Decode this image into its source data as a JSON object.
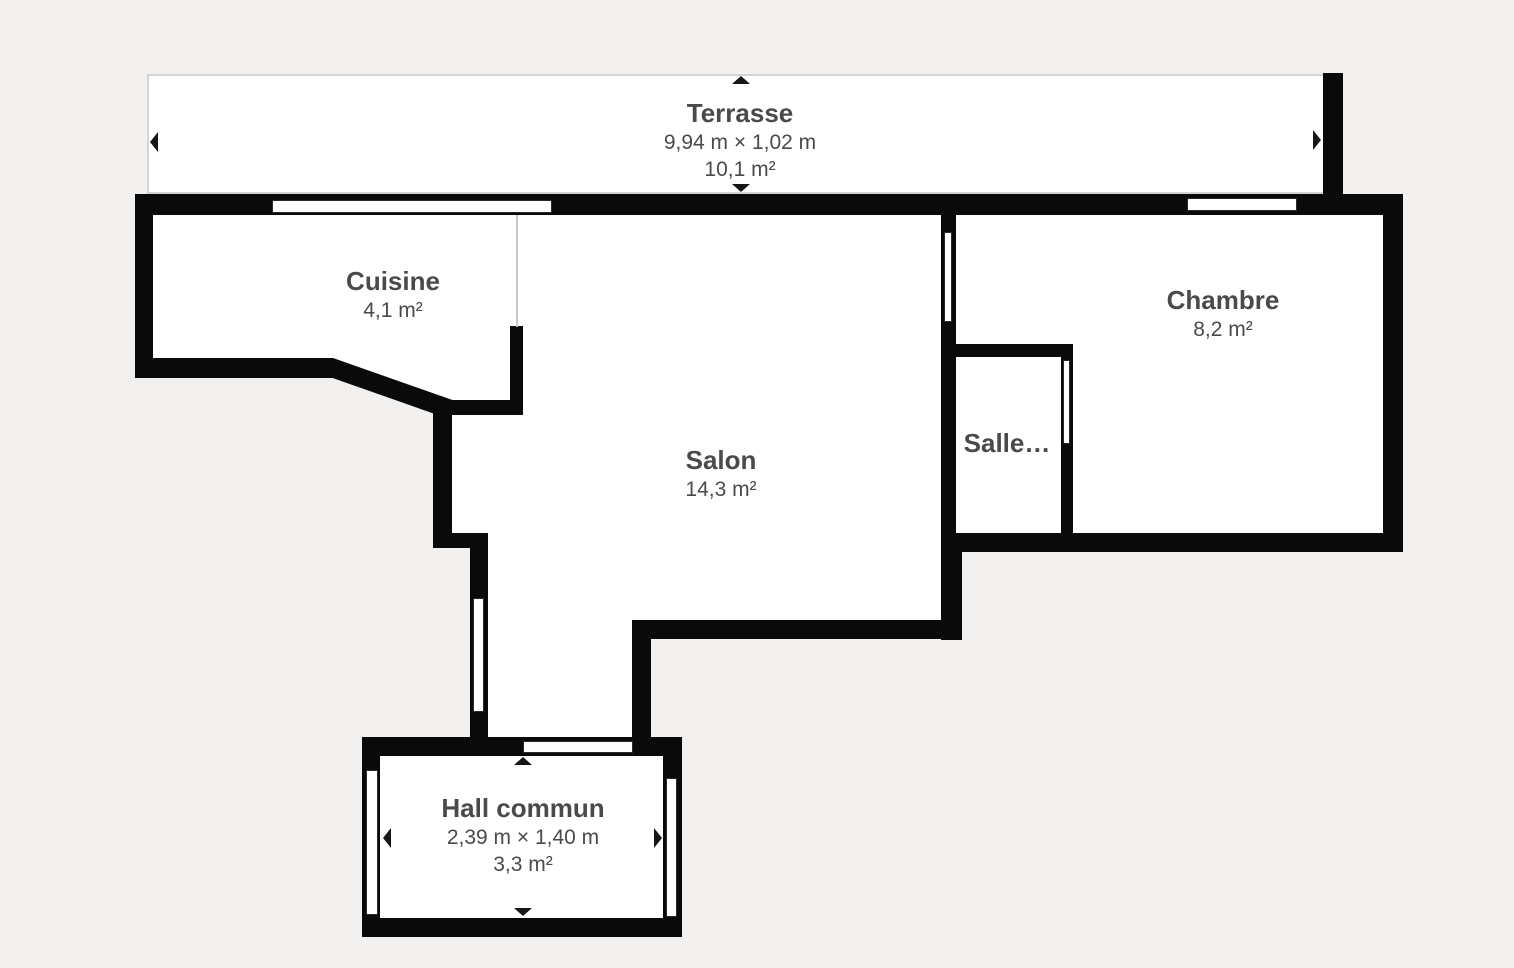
{
  "canvas": {
    "background_color": "#f2f1ef",
    "wall_color": "#0a0a0a",
    "room_fill_color": "#ffffff",
    "label_color": "#4a4a4a",
    "terrace_border_color": "#d4d4d4",
    "marker_color": "#161616",
    "divider_color": "#c8c8c7"
  },
  "rooms": {
    "terrasse": {
      "name": "Terrasse",
      "dimensions": "9,94 m × 1,02 m",
      "area": "10,1 m²"
    },
    "cuisine": {
      "name": "Cuisine",
      "area": "4,1 m²"
    },
    "salon": {
      "name": "Salon",
      "area": "14,3 m²"
    },
    "chambre": {
      "name": "Chambre",
      "area": "8,2 m²"
    },
    "salle": {
      "name": "Salle…"
    },
    "hall": {
      "name": "Hall commun",
      "dimensions": "2,39 m × 1,40 m",
      "area": "3,3 m²"
    }
  }
}
